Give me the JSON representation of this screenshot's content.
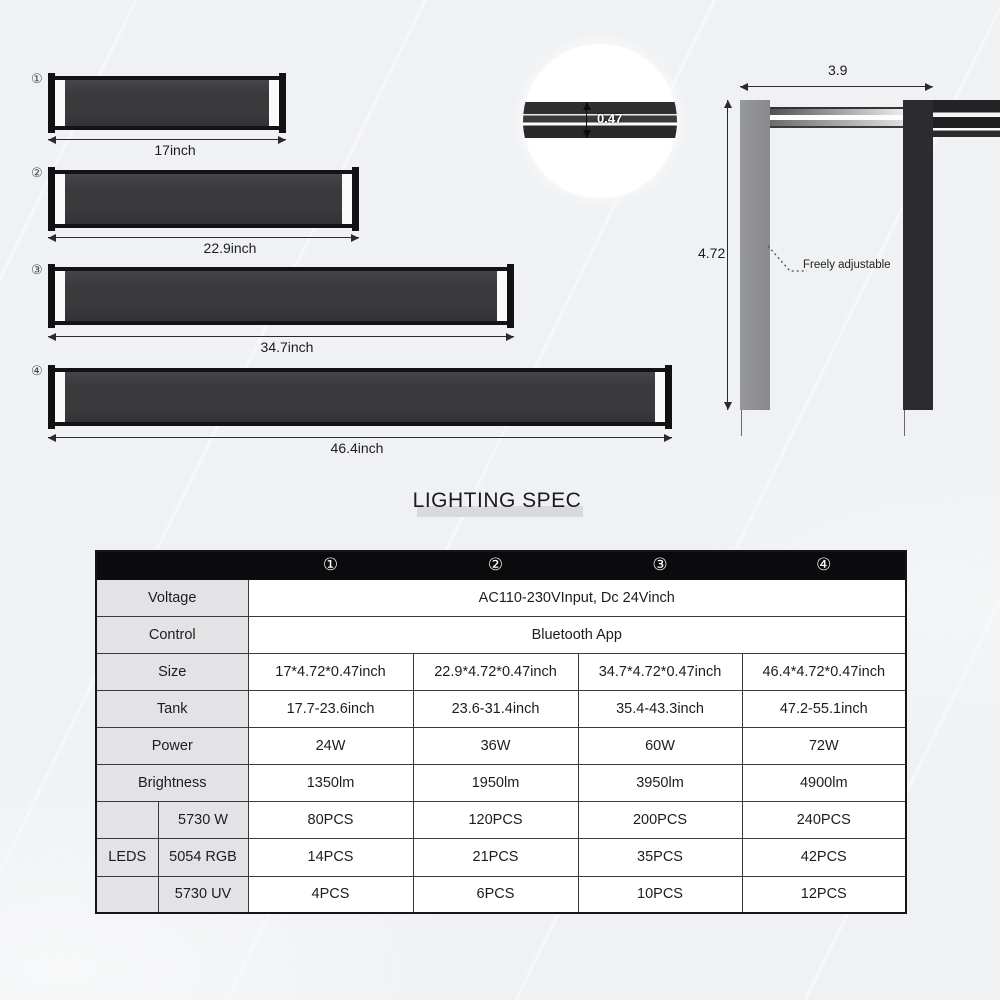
{
  "size_diagram": {
    "bars": [
      {
        "badge": "①",
        "dim": "17inch"
      },
      {
        "badge": "②",
        "dim": "22.9inch"
      },
      {
        "badge": "③",
        "dim": "34.7inch"
      },
      {
        "badge": "④",
        "dim": "46.4inch"
      }
    ],
    "thickness_detail": {
      "label": "0.47"
    },
    "side_view": {
      "width": "3.9",
      "height": "4.72",
      "note": "Freely adjustable"
    }
  },
  "spec_table": {
    "title": "LIGHTING SPEC",
    "col_headers": [
      "①",
      "②",
      "③",
      "④"
    ],
    "voltage": {
      "label": "Voltage",
      "value": "AC110-230VInput, Dc 24Vinch"
    },
    "control": {
      "label": "Control",
      "value": "Bluetooth App"
    },
    "size": {
      "label": "Size",
      "values": [
        "17*4.72*0.47inch",
        "22.9*4.72*0.47inch",
        "34.7*4.72*0.47inch",
        "46.4*4.72*0.47inch"
      ]
    },
    "tank": {
      "label": "Tank",
      "values": [
        "17.7-23.6inch",
        "23.6-31.4inch",
        "35.4-43.3inch",
        "47.2-55.1inch"
      ]
    },
    "power": {
      "label": "Power",
      "values": [
        "24W",
        "36W",
        "60W",
        "72W"
      ]
    },
    "brightness": {
      "label": "Brightness",
      "values": [
        "1350lm",
        "1950lm",
        "3950lm",
        "4900lm"
      ]
    },
    "leds": {
      "group_label": "LEDS",
      "rows": [
        {
          "label": "5730 W",
          "values": [
            "80PCS",
            "120PCS",
            "200PCS",
            "240PCS"
          ]
        },
        {
          "label": "5054 RGB",
          "values": [
            "14PCS",
            "21PCS",
            "35PCS",
            "42PCS"
          ]
        },
        {
          "label": "5730 UV",
          "values": [
            "4PCS",
            "6PCS",
            "10PCS",
            "12PCS"
          ]
        }
      ]
    }
  },
  "colors": {
    "bar_body": "#3a3a3d",
    "header_bg": "#0b0b0d",
    "label_cell_bg": "#e3e3e5",
    "leg_gray": "#8d8e90",
    "leg_dark": "#2c2c30"
  }
}
